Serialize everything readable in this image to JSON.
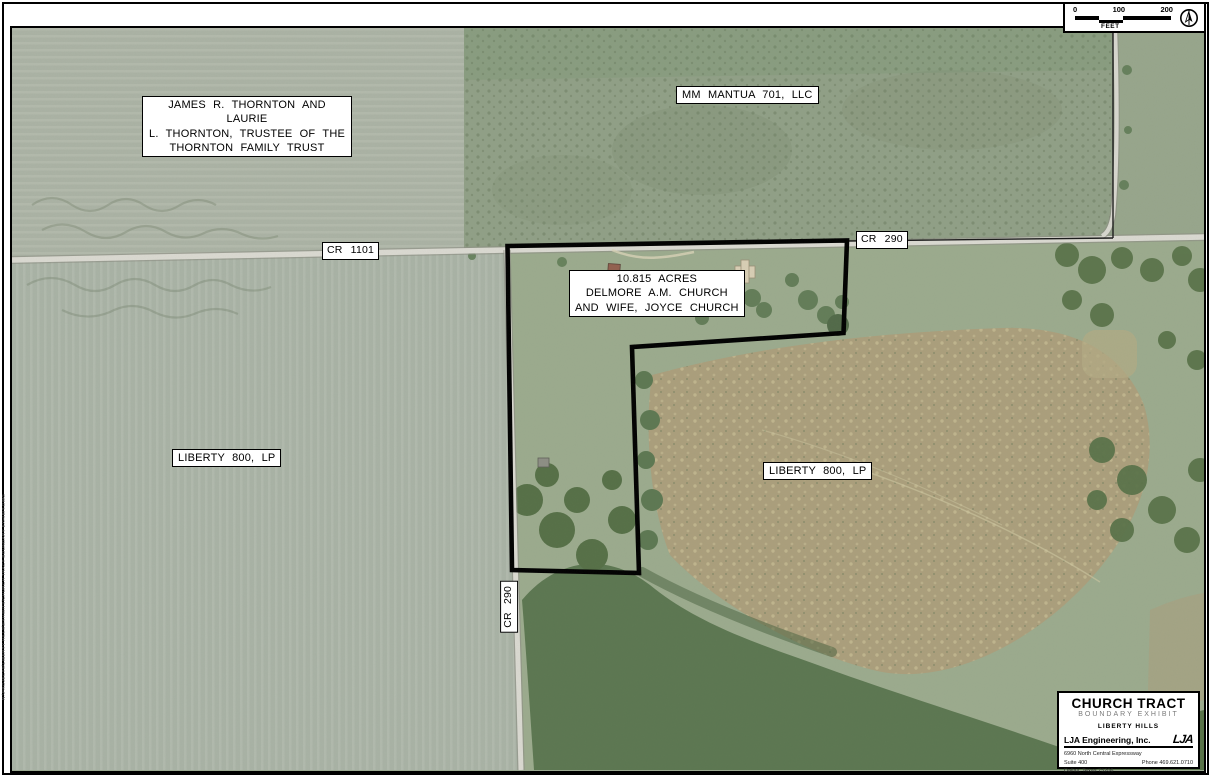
{
  "map": {
    "labels": {
      "thornton": "JAMES R. THORNTON AND LAURIE\nL. THORNTON, TRUSTEE OF THE\nTHORNTON FAMILY TRUST",
      "mantua": "MM MANTUA 701, LLC",
      "church_tract": "10.815 ACRES\nDELMORE A.M. CHURCH\nAND WIFE, JOYCE CHURCH",
      "liberty_west": "LIBERTY 800, LP",
      "liberty_east": "LIBERTY 800, LP",
      "cr1101": "CR 1101",
      "cr290_east": "CR 290",
      "cr290_south": "CR 290"
    },
    "boundary_color": "#000000",
    "plot_stamp": "N:\\PROJECTS\\LIBERTY HILLS\\EXHIBITS\\CHURCH TRACT BOUNDARY EXHIBIT.DWG"
  },
  "scalebar": {
    "tick0": "0",
    "tick1": "100",
    "tick2": "200",
    "unit": "FEET"
  },
  "titleblock": {
    "title": "CHURCH TRACT",
    "subtitle": "BOUNDARY EXHIBIT",
    "project": "LIBERTY HILLS",
    "company": "LJA Engineering, Inc.",
    "logo": "LJA",
    "address": "6960 North Central Expressway\nSuite 400\nDallas, Texas 75206",
    "phone": "Phone 469.621.0710",
    "frn": "FRN - F-1386"
  }
}
